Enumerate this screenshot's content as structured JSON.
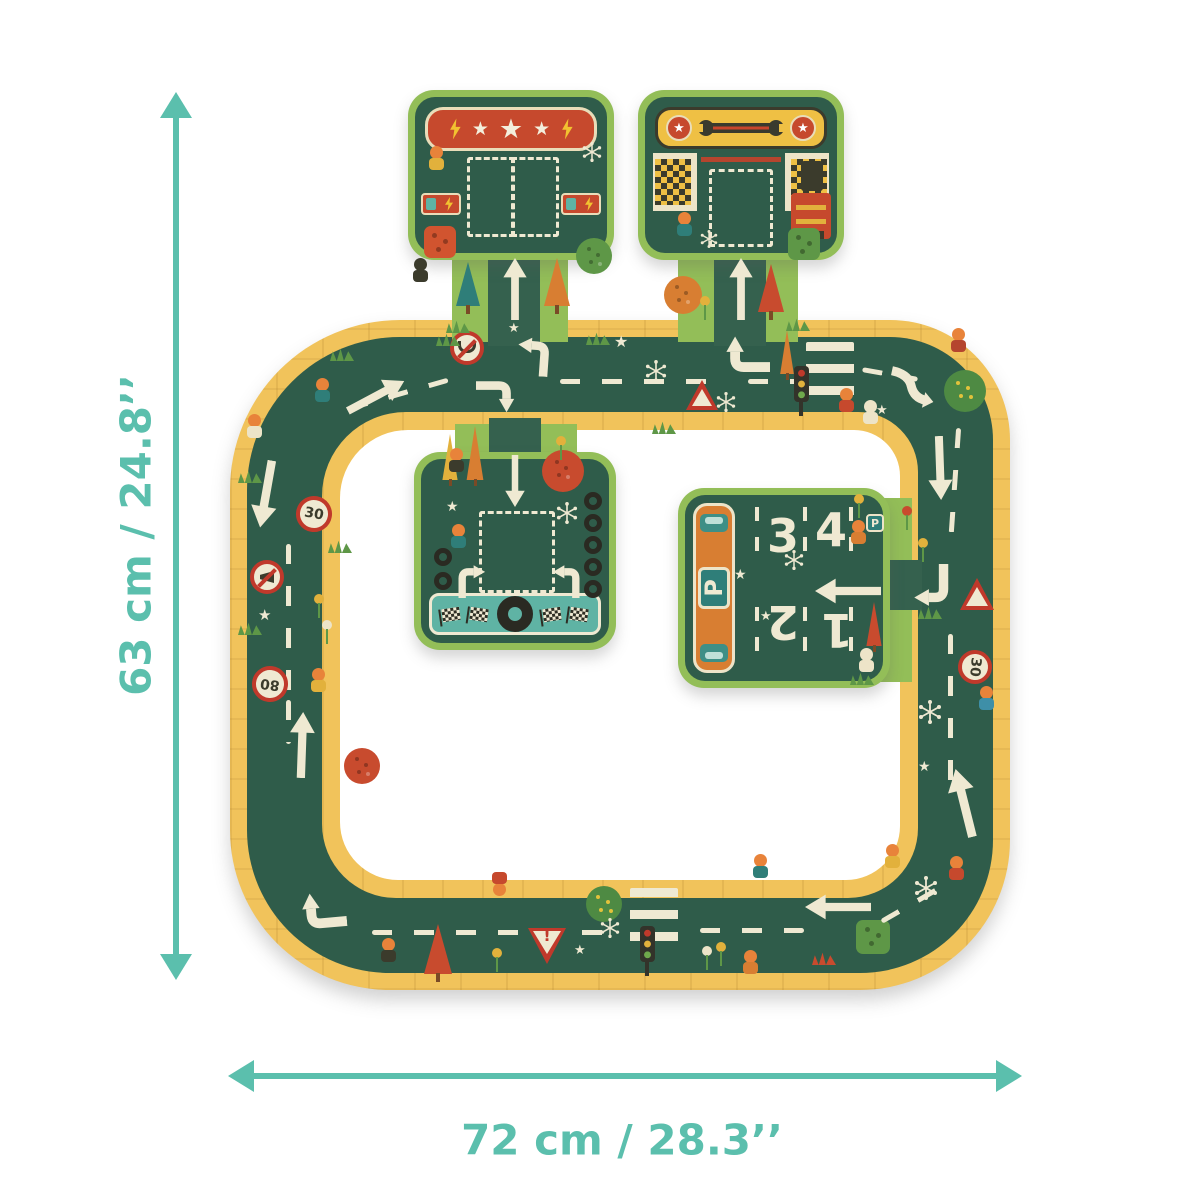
{
  "palette": {
    "accent_teal": "#5BBFAD",
    "road_green": "#2F5C4A",
    "edge_yellow": "#F1C35B",
    "grass_green": "#93BE58",
    "banner_red": "#C6492D",
    "cream": "#EFE9D2",
    "orange": "#D87E32",
    "sign_red": "#C0392B"
  },
  "dimensions": {
    "height_label": "63 cm / 24.8’’",
    "width_label": "72 cm / 28.3’’"
  },
  "pieces": {
    "charging": {
      "star": "★"
    },
    "garage": {
      "medal_star": "★"
    },
    "parking": {
      "p_label": "P",
      "spaces": [
        "1",
        "2",
        "3",
        "4"
      ]
    }
  },
  "signs": {
    "speed30": "30",
    "speed80": "80",
    "yield_mark": "!",
    "warning_dot": "●"
  },
  "decorations": [
    {
      "t": "dash-h",
      "n": "lane-dashes",
      "x": 346,
      "y": 392,
      "w": 104,
      "r": -16
    },
    {
      "t": "arrow",
      "n": "road-arrow",
      "x": 362,
      "y": 364,
      "w": 28,
      "h": 64,
      "r": 62
    },
    {
      "t": "signNoU",
      "n": "no-uturn-sign",
      "x": 450,
      "y": 331,
      "w": 34,
      "h": 34
    },
    {
      "t": "elbowL",
      "n": "turn-arrow",
      "x": 512,
      "y": 334,
      "w": 42,
      "h": 42,
      "r": 4
    },
    {
      "t": "elbowR",
      "n": "turn-arrow",
      "x": 476,
      "y": 376,
      "w": 42,
      "h": 42,
      "r": 90
    },
    {
      "t": "dash-h",
      "n": "lane-dashes",
      "x": 560,
      "y": 379,
      "w": 148
    },
    {
      "t": "spark6",
      "n": "sparkle-icon",
      "x": 645,
      "y": 360,
      "w": 22,
      "h": 22
    },
    {
      "t": "pennant",
      "n": "pennant-tree",
      "x": 778,
      "y": 330,
      "w": 18,
      "h": 50,
      "c": "#D87E32"
    },
    {
      "t": "elbowR",
      "n": "turn-arrow",
      "x": 722,
      "y": 330,
      "w": 48,
      "h": 48,
      "r": -90
    },
    {
      "t": "warning",
      "n": "warning-sign",
      "x": 686,
      "y": 380,
      "w": 32,
      "h": 30,
      "tx": "●"
    },
    {
      "t": "spark6",
      "n": "sparkle-icon",
      "x": 716,
      "y": 392,
      "w": 20,
      "h": 20
    },
    {
      "t": "dash-h",
      "n": "lane-dashes",
      "x": 748,
      "y": 379,
      "w": 52
    },
    {
      "t": "cross",
      "n": "crosswalk",
      "x": 806,
      "y": 342,
      "w": 48,
      "h": 62
    },
    {
      "t": "tlight",
      "n": "traffic-light-icon",
      "x": 794,
      "y": 366
    },
    {
      "t": "char",
      "n": "pedestrian",
      "x": 838,
      "y": 388,
      "c": "#C6492D"
    },
    {
      "t": "char",
      "n": "dog",
      "x": 862,
      "y": 400,
      "c": "#EDE4C8",
      "hc": "#EDE4C8"
    },
    {
      "t": "scurve",
      "n": "curve-arrow",
      "x": 886,
      "y": 366,
      "w": 50,
      "h": 42,
      "r": 12
    },
    {
      "t": "dash-h",
      "n": "lane-dashes",
      "x": 862,
      "y": 372,
      "w": 56,
      "r": 10
    },
    {
      "t": "bush",
      "n": "bush",
      "x": 944,
      "y": 370,
      "w": 42,
      "h": 42
    },
    {
      "t": "char",
      "n": "figure",
      "x": 950,
      "y": 328,
      "c": "#B5452E"
    },
    {
      "t": "star",
      "n": "star-icon",
      "x": 614,
      "y": 334,
      "fs": 16,
      "tx": "★"
    },
    {
      "t": "star",
      "n": "star-icon",
      "x": 876,
      "y": 404,
      "fs": 13,
      "tx": "★"
    },
    {
      "t": "grass",
      "n": "grass-tuft",
      "x": 330,
      "y": 348
    },
    {
      "t": "grass",
      "n": "grass-tuft",
      "x": 436,
      "y": 333
    },
    {
      "t": "grass",
      "n": "grass-tuft",
      "x": 586,
      "y": 332
    },
    {
      "t": "grass",
      "n": "grass-tuft",
      "x": 652,
      "y": 421
    },
    {
      "t": "char",
      "n": "figure",
      "x": 246,
      "y": 414,
      "c": "#EDE4C8"
    },
    {
      "t": "char",
      "n": "figure",
      "x": 314,
      "y": 378,
      "c": "#2F7E79"
    },
    {
      "t": "arrow",
      "n": "road-arrow",
      "x": 252,
      "y": 460,
      "w": 28,
      "h": 68,
      "r": 190
    },
    {
      "t": "signc",
      "n": "speed-30-sign",
      "x": 296,
      "y": 496,
      "w": 36,
      "h": 36,
      "tx": "30",
      "r": 10
    },
    {
      "t": "dash-v",
      "n": "lane-dashes",
      "x": 286,
      "y": 544,
      "h": 150
    },
    {
      "t": "signNoHorn",
      "n": "no-horn-sign",
      "x": 250,
      "y": 560,
      "w": 34,
      "h": 34
    },
    {
      "t": "flower",
      "n": "flower",
      "x": 314,
      "y": 594,
      "c": "#E2B13C"
    },
    {
      "t": "flower",
      "n": "flower",
      "x": 322,
      "y": 620,
      "c": "#EDE4C8"
    },
    {
      "t": "star",
      "n": "star-icon",
      "x": 258,
      "y": 608,
      "fs": 15,
      "tx": "★"
    },
    {
      "t": "signc",
      "n": "speed-80-sign",
      "x": 252,
      "y": 666,
      "w": 36,
      "h": 36,
      "tx": "80",
      "r": 187
    },
    {
      "t": "char",
      "n": "figure",
      "x": 310,
      "y": 668,
      "c": "#E2B13C"
    },
    {
      "t": "dash-v",
      "n": "lane-dashes",
      "x": 286,
      "y": 700,
      "h": 44
    },
    {
      "t": "arrow",
      "n": "road-arrow",
      "x": 288,
      "y": 712,
      "w": 28,
      "h": 66,
      "r": 2
    },
    {
      "t": "grass",
      "n": "grass-tuft",
      "x": 238,
      "y": 470
    },
    {
      "t": "grass",
      "n": "grass-tuft",
      "x": 328,
      "y": 540
    },
    {
      "t": "grass",
      "n": "grass-tuft",
      "x": 238,
      "y": 622
    },
    {
      "t": "roundtree",
      "n": "round-tree",
      "x": 344,
      "y": 748,
      "w": 36,
      "h": 36,
      "c": "#C84B2E"
    },
    {
      "t": "elbowR",
      "n": "turn-arrow",
      "x": 298,
      "y": 886,
      "w": 48,
      "h": 48,
      "r": -95
    },
    {
      "t": "dash-h",
      "n": "lane-dashes",
      "x": 372,
      "y": 930,
      "w": 236
    },
    {
      "t": "char",
      "n": "figure",
      "x": 380,
      "y": 938,
      "c": "#3B3B2C"
    },
    {
      "t": "pine",
      "n": "pine-tree",
      "x": 424,
      "y": 924,
      "w": 28,
      "h": 58,
      "c": "#C84B2E"
    },
    {
      "t": "flower",
      "n": "flower",
      "x": 492,
      "y": 948,
      "c": "#E2B13C"
    },
    {
      "t": "yield",
      "n": "yield-sign",
      "x": 528,
      "y": 928,
      "w": 38,
      "h": 36,
      "tx": "!"
    },
    {
      "t": "char",
      "n": "figure",
      "x": 492,
      "y": 870,
      "c": "#C6492D",
      "r": 180
    },
    {
      "t": "bush",
      "n": "bush",
      "x": 586,
      "y": 886,
      "w": 36,
      "h": 36
    },
    {
      "t": "star",
      "n": "star-icon",
      "x": 574,
      "y": 944,
      "fs": 13,
      "tx": "★"
    },
    {
      "t": "cross",
      "n": "crosswalk",
      "x": 630,
      "y": 888,
      "w": 48,
      "h": 64
    },
    {
      "t": "tlight",
      "n": "traffic-light-icon",
      "x": 640,
      "y": 926
    },
    {
      "t": "spark6",
      "n": "sparkle-icon",
      "x": 600,
      "y": 918,
      "w": 20,
      "h": 20
    },
    {
      "t": "flower",
      "n": "flower",
      "x": 702,
      "y": 946,
      "c": "#EDE4C8"
    },
    {
      "t": "flower",
      "n": "flower",
      "x": 716,
      "y": 942,
      "c": "#E2B13C"
    },
    {
      "t": "char",
      "n": "dog",
      "x": 742,
      "y": 950,
      "c": "#D87E32"
    },
    {
      "t": "dash-h",
      "n": "lane-dashes",
      "x": 700,
      "y": 928,
      "w": 104
    },
    {
      "t": "char",
      "n": "figure",
      "x": 752,
      "y": 854,
      "c": "#2F7E79"
    },
    {
      "t": "arrow",
      "n": "road-arrow",
      "x": 824,
      "y": 874,
      "w": 28,
      "h": 66,
      "r": -90
    },
    {
      "t": "sqtree",
      "n": "apple-tree",
      "x": 856,
      "y": 920,
      "w": 34,
      "h": 34,
      "c": "#5E9747"
    },
    {
      "t": "grass",
      "n": "grass-tuft",
      "x": 812,
      "y": 952,
      "c": "#C84B2E"
    },
    {
      "t": "dash-h",
      "n": "lane-dashes",
      "x": 876,
      "y": 898,
      "w": 84,
      "r": -30
    },
    {
      "t": "spark6",
      "n": "sparkle-icon",
      "x": 914,
      "y": 876,
      "w": 24,
      "h": 24
    },
    {
      "t": "char",
      "n": "figure",
      "x": 884,
      "y": 844,
      "c": "#E2B13C"
    },
    {
      "t": "char",
      "n": "figure",
      "x": 948,
      "y": 856,
      "c": "#C6492D"
    },
    {
      "t": "arrow",
      "n": "road-arrow",
      "x": 926,
      "y": 436,
      "w": 28,
      "h": 64,
      "r": 178
    },
    {
      "t": "dash-v",
      "n": "lane-dashes",
      "x": 952,
      "y": 428,
      "h": 118,
      "r": 4
    },
    {
      "t": "flower",
      "n": "flower",
      "x": 902,
      "y": 506,
      "c": "#C84B2E"
    },
    {
      "t": "flower",
      "n": "flower",
      "x": 918,
      "y": 538,
      "c": "#E2B13C"
    },
    {
      "t": "elbowR",
      "n": "turn-arrow",
      "x": 908,
      "y": 564,
      "w": 46,
      "h": 46,
      "r": 180
    },
    {
      "t": "warning",
      "n": "warning-sign",
      "x": 960,
      "y": 578,
      "w": 34,
      "h": 32,
      "tx": "●"
    },
    {
      "t": "dash-v",
      "n": "lane-dashes",
      "x": 948,
      "y": 634,
      "h": 160
    },
    {
      "t": "signc",
      "n": "speed-30-sign",
      "x": 958,
      "y": 650,
      "w": 34,
      "h": 34,
      "tx": "30",
      "r": 95
    },
    {
      "t": "char",
      "n": "figure",
      "x": 978,
      "y": 686,
      "c": "#3E8FA8"
    },
    {
      "t": "spark6",
      "n": "sparkle-icon",
      "x": 918,
      "y": 700,
      "w": 24,
      "h": 24
    },
    {
      "t": "arrow",
      "n": "road-arrow",
      "x": 950,
      "y": 768,
      "w": 28,
      "h": 70,
      "r": -14
    },
    {
      "t": "star",
      "n": "star-icon",
      "x": 918,
      "y": 760,
      "fs": 14,
      "tx": "★"
    },
    {
      "t": "grass",
      "n": "grass-tuft",
      "x": 918,
      "y": 606
    },
    {
      "t": "char",
      "n": "figure",
      "x": 428,
      "y": 146,
      "c": "#E2B13C"
    },
    {
      "t": "spark6",
      "n": "sparkle-icon",
      "x": 582,
      "y": 142,
      "w": 20,
      "h": 20
    },
    {
      "t": "sqtree",
      "n": "apple-tree",
      "x": 424,
      "y": 226,
      "w": 32,
      "h": 32,
      "c": "#D1542F"
    },
    {
      "t": "pine",
      "n": "pine-tree",
      "x": 456,
      "y": 262,
      "w": 24,
      "h": 52,
      "c": "#2F7E79"
    },
    {
      "t": "pine",
      "n": "pine-tree",
      "x": 544,
      "y": 258,
      "w": 26,
      "h": 56,
      "c": "#D87E32"
    },
    {
      "t": "roundtree",
      "n": "apple-tree",
      "x": 576,
      "y": 238,
      "w": 36,
      "h": 36,
      "c": "#5E9747"
    },
    {
      "t": "char",
      "n": "bird",
      "x": 412,
      "y": 258,
      "c": "#3B3B2C",
      "hc": "#3B3B2C"
    },
    {
      "t": "arrow",
      "n": "road-arrow",
      "x": 502,
      "y": 258,
      "w": 26,
      "h": 62
    },
    {
      "t": "grass",
      "n": "grass-tuft",
      "x": 446,
      "y": 320
    },
    {
      "t": "star",
      "n": "star-icon",
      "x": 508,
      "y": 322,
      "fs": 13,
      "tx": "★"
    },
    {
      "t": "char",
      "n": "mechanic",
      "x": 676,
      "y": 212,
      "c": "#2F7E79"
    },
    {
      "t": "arrow",
      "n": "road-arrow",
      "x": 728,
      "y": 258,
      "w": 26,
      "h": 62
    },
    {
      "t": "roundtree",
      "n": "round-tree",
      "x": 664,
      "y": 276,
      "w": 38,
      "h": 38,
      "c": "#D87E32"
    },
    {
      "t": "pine",
      "n": "pine-tree",
      "x": 758,
      "y": 264,
      "w": 26,
      "h": 56,
      "c": "#C84B2E"
    },
    {
      "t": "sqtree",
      "n": "apple-tree",
      "x": 788,
      "y": 228,
      "w": 32,
      "h": 32,
      "c": "#5E9747"
    },
    {
      "t": "flower",
      "n": "flower",
      "x": 700,
      "y": 296,
      "c": "#E2B13C"
    },
    {
      "t": "grass",
      "n": "grass-tuft",
      "x": 786,
      "y": 318
    },
    {
      "t": "spark6",
      "n": "sparkle-icon",
      "x": 700,
      "y": 230,
      "w": 18,
      "h": 18
    },
    {
      "t": "pennant",
      "n": "pennant-tree",
      "x": 440,
      "y": 434,
      "w": 20,
      "h": 52,
      "c": "#E2B13C"
    },
    {
      "t": "pennant",
      "n": "pennant-tree",
      "x": 464,
      "y": 426,
      "w": 22,
      "h": 60,
      "c": "#D87E32"
    },
    {
      "t": "char",
      "n": "biker",
      "x": 448,
      "y": 448,
      "c": "#3B3B2C"
    },
    {
      "t": "roundtree",
      "n": "round-tree",
      "x": 542,
      "y": 450,
      "w": 42,
      "h": 42,
      "c": "#C84B2E"
    },
    {
      "t": "flower",
      "n": "flower",
      "x": 556,
      "y": 436,
      "c": "#E2B13C"
    },
    {
      "t": "arrow",
      "n": "road-arrow",
      "x": 502,
      "y": 455,
      "w": 26,
      "h": 52,
      "r": 180
    },
    {
      "t": "spark6",
      "n": "sparkle-icon",
      "x": 556,
      "y": 502,
      "w": 22,
      "h": 22
    },
    {
      "t": "star",
      "n": "star-icon",
      "x": 446,
      "y": 500,
      "fs": 14,
      "tx": "★"
    },
    {
      "t": "tire",
      "n": "tire-icon",
      "x": 584,
      "y": 492
    },
    {
      "t": "tire",
      "n": "tire-icon",
      "x": 584,
      "y": 514
    },
    {
      "t": "tire",
      "n": "tire-icon",
      "x": 584,
      "y": 536
    },
    {
      "t": "tire",
      "n": "tire-icon",
      "x": 584,
      "y": 558
    },
    {
      "t": "tire",
      "n": "tire-icon",
      "x": 584,
      "y": 580
    },
    {
      "t": "tire",
      "n": "tire-icon",
      "x": 434,
      "y": 548
    },
    {
      "t": "tire",
      "n": "tire-icon",
      "x": 434,
      "y": 572
    },
    {
      "t": "elbowR",
      "n": "turn-arrow",
      "x": 454,
      "y": 562,
      "w": 36,
      "h": 36
    },
    {
      "t": "elbowL",
      "n": "turn-arrow",
      "x": 548,
      "y": 562,
      "w": 36,
      "h": 36
    },
    {
      "t": "char",
      "n": "scooter-rider",
      "x": 450,
      "y": 524,
      "c": "#2F7E79"
    },
    {
      "t": "flower",
      "n": "flower",
      "x": 854,
      "y": 494,
      "c": "#E2B13C"
    },
    {
      "t": "char",
      "n": "fox",
      "x": 850,
      "y": 520,
      "c": "#D87E32"
    },
    {
      "t": "psign",
      "n": "parking-sign-small",
      "x": 866,
      "y": 514,
      "tx": "P"
    },
    {
      "t": "arrow",
      "n": "road-arrow",
      "x": 834,
      "y": 558,
      "w": 28,
      "h": 66,
      "r": -90
    },
    {
      "t": "spark6",
      "n": "sparkle-icon",
      "x": 784,
      "y": 550,
      "w": 20,
      "h": 20
    },
    {
      "t": "star",
      "n": "star-icon",
      "x": 734,
      "y": 568,
      "fs": 14,
      "tx": "★"
    },
    {
      "t": "star",
      "n": "star-icon",
      "x": 760,
      "y": 610,
      "fs": 13,
      "tx": "★"
    },
    {
      "t": "pennant",
      "n": "pennant-tree",
      "x": 864,
      "y": 602,
      "w": 20,
      "h": 50,
      "c": "#C84B2E"
    },
    {
      "t": "char",
      "n": "rabbit",
      "x": 858,
      "y": 648,
      "c": "#EDE4C8",
      "hc": "#EDE4C8"
    },
    {
      "t": "grass",
      "n": "grass-tuft",
      "x": 850,
      "y": 672
    }
  ]
}
